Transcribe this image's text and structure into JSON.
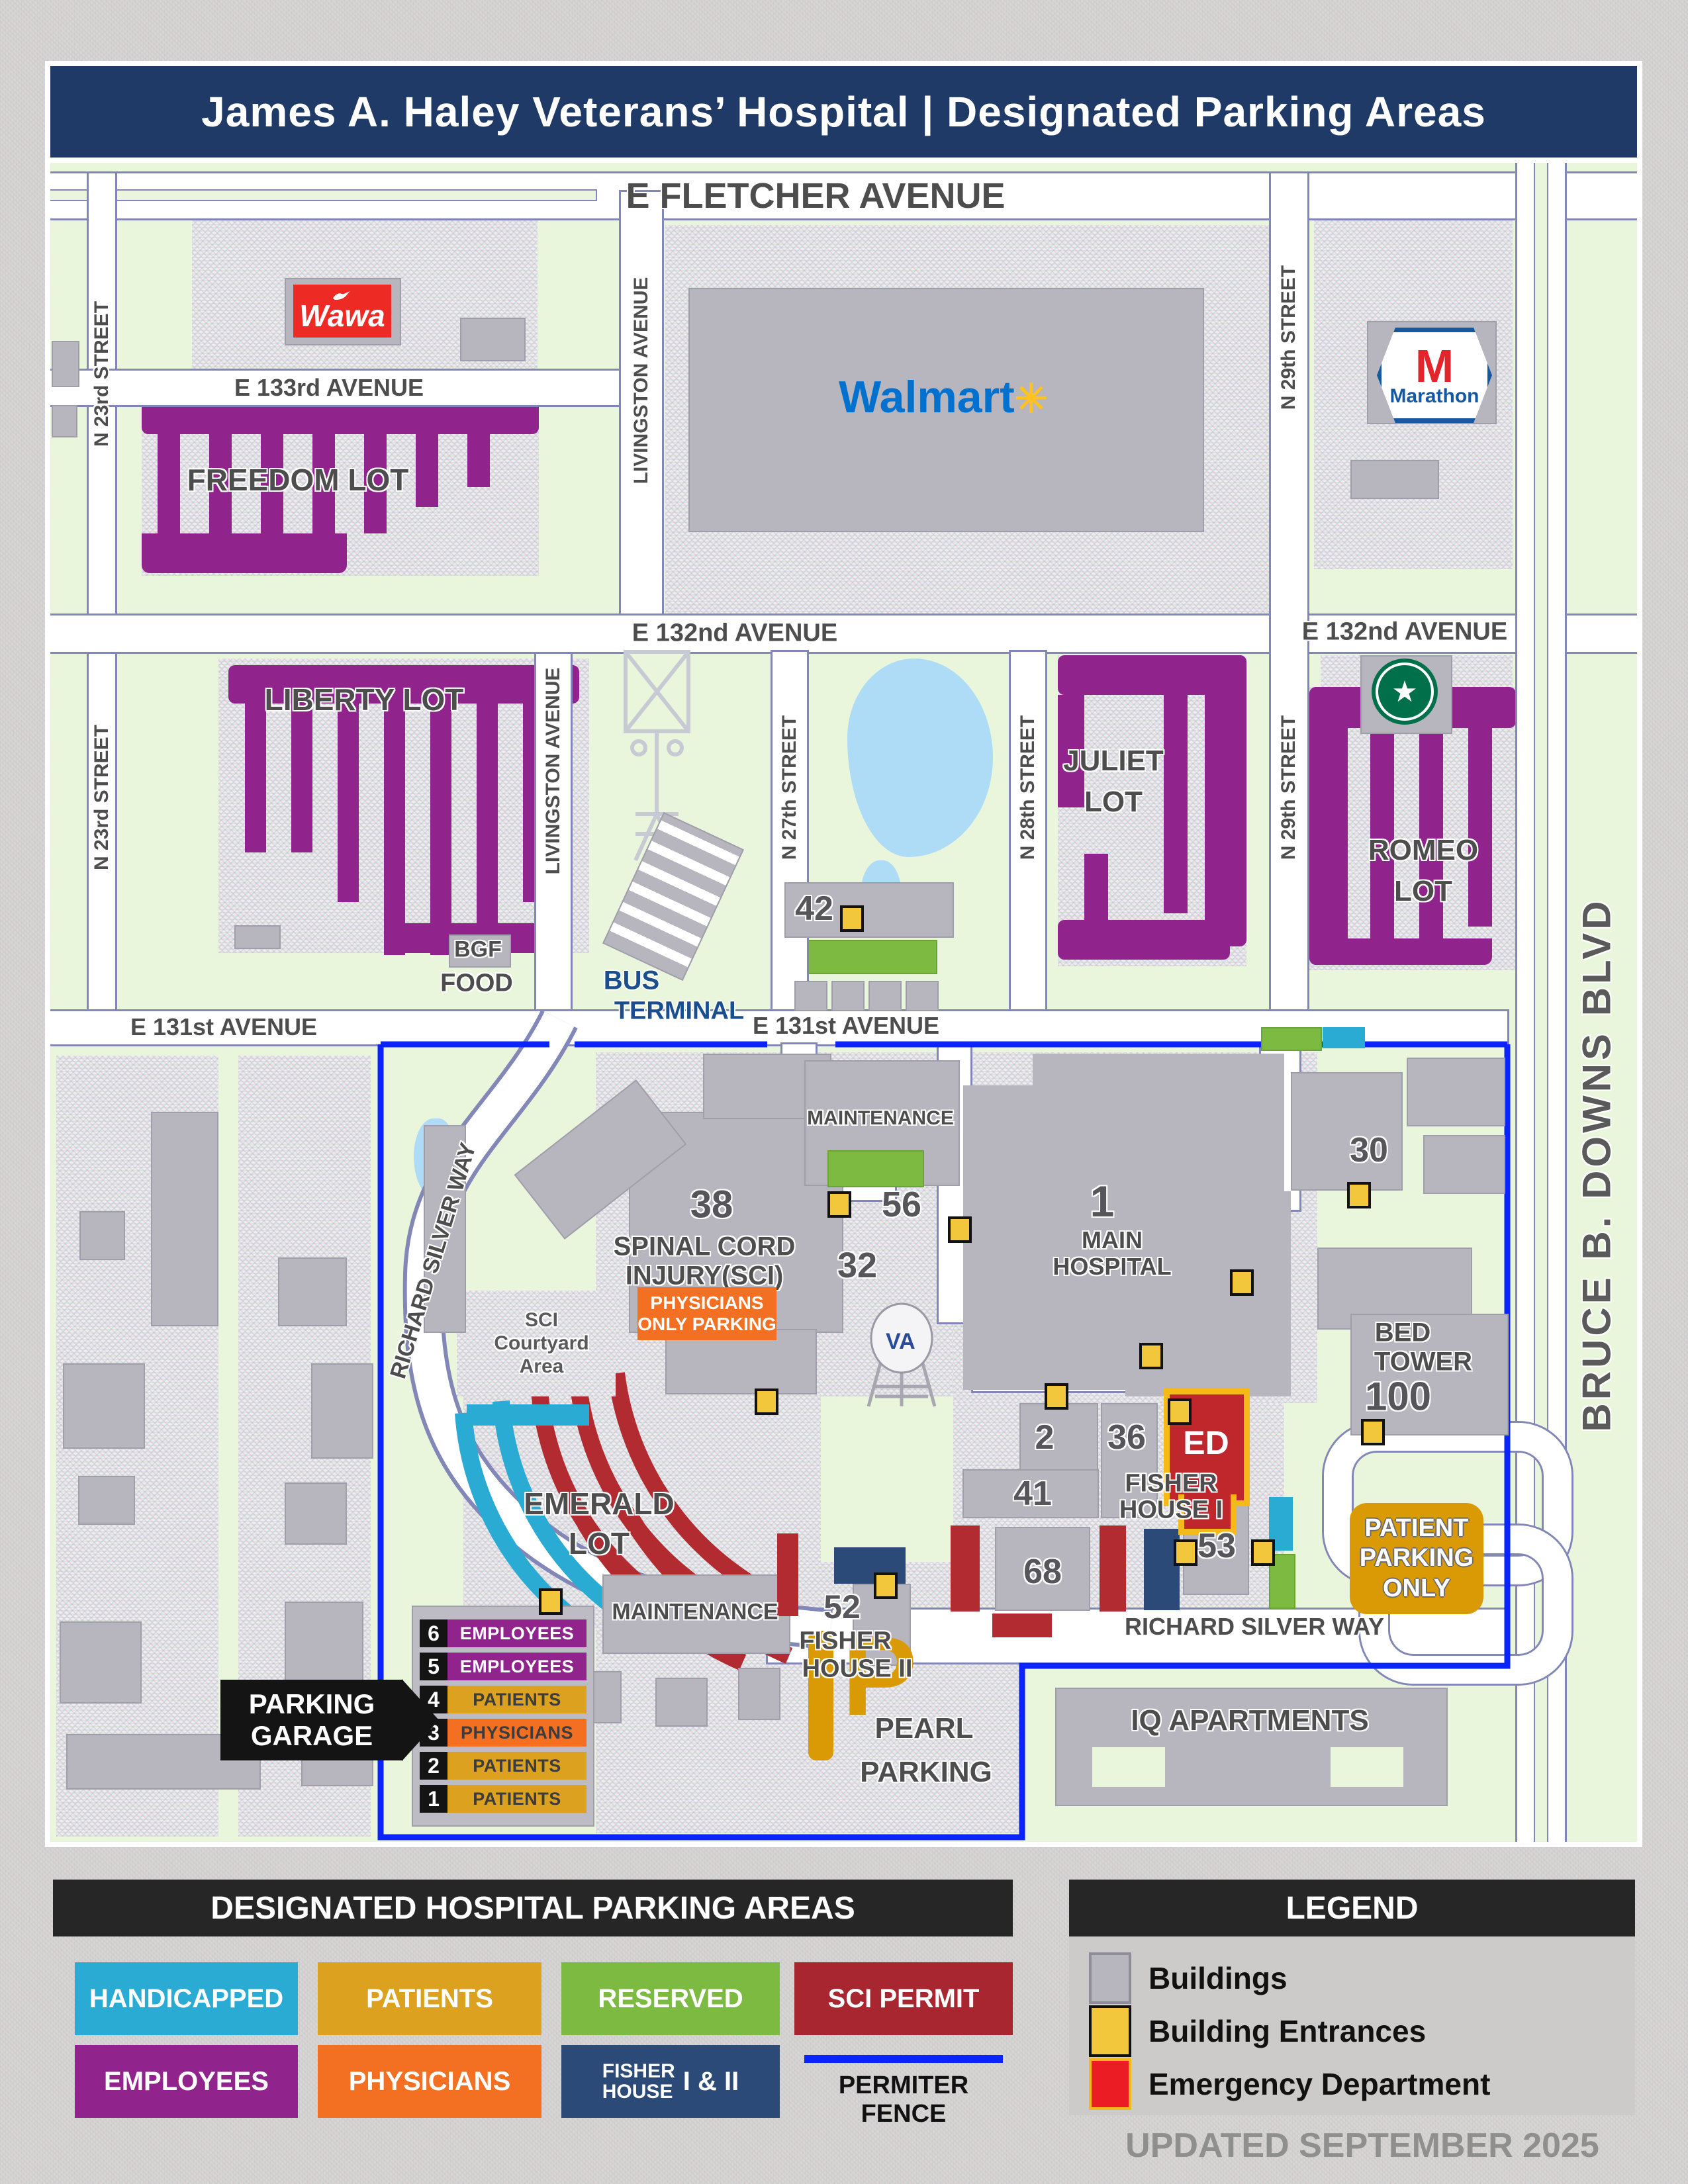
{
  "title": "James A. Haley Veterans’ Hospital  |  Designated Parking Areas",
  "streets": {
    "fletcher": "E FLETCHER AVENUE",
    "e133": "E 133rd AVENUE",
    "e132": "E 132nd AVENUE",
    "e131": "E 131st AVENUE",
    "n23": "N 23rd STREET",
    "livingston": "LIVINGSTON AVENUE",
    "n27": "N 27th STREET",
    "n28": "N 28th STREET",
    "n29": "N 29th STREET",
    "bbd": "BRUCE B. DOWNS BLVD",
    "rsw": "RICHARD SILVER WAY"
  },
  "lots": {
    "freedom": "FREEDOM LOT",
    "liberty": "LIBERTY LOT",
    "juliet_1": "JULIET",
    "juliet_2": "LOT",
    "romeo_1": "ROMEO",
    "romeo_2": "LOT",
    "emerald_1": "EMERALD",
    "emerald_2": "LOT",
    "pearl_1": "PEARL",
    "pearl_2": "PARKING"
  },
  "places": {
    "wawa": "Wawa",
    "walmart": "Walmart",
    "marathon_m": "M",
    "marathon": "Marathon",
    "bgf_1": "BGF",
    "bgf_2": "FOOD",
    "bus_1": "BUS",
    "bus_2": "TERMINAL",
    "iq": "IQ APARTMENTS"
  },
  "campus": {
    "b38_num": "38",
    "b38_1": "SPINAL CORD",
    "b38_2": "INJURY(SCI)",
    "court_1": "SCI",
    "court_2": "Courtyard",
    "court_3": "Area",
    "maintenance": "MAINTENANCE",
    "b56": "56",
    "b32": "32",
    "b1_num": "1",
    "b1_1": "MAIN",
    "b1_2": "HOSPITAL",
    "b30": "30",
    "bed_1": "BED",
    "bed_2": "TOWER",
    "bed_num": "100",
    "b2": "2",
    "b36": "36",
    "ed": "ED",
    "b41": "41",
    "b68": "68",
    "b52": "52",
    "fh2_1": "FISHER",
    "fh2_2": "HOUSE II",
    "b53": "53",
    "fh1_1": "FISHER",
    "fh1_2": "HOUSE I",
    "b42": "42",
    "va": "VA"
  },
  "signs": {
    "ppo_1": "PHYSICIANS",
    "ppo_2": "ONLY PARKING",
    "patient_1": "PATIENT",
    "patient_2": "PARKING",
    "patient_3": "ONLY",
    "garage_1": "PARKING",
    "garage_2": "GARAGE"
  },
  "garage_levels": [
    {
      "num": "6",
      "label": "EMPLOYEES",
      "color": "#90248C"
    },
    {
      "num": "5",
      "label": "EMPLOYEES",
      "color": "#90248C"
    },
    {
      "num": "4",
      "label": "PATIENTS",
      "color": "#DCA21F"
    },
    {
      "num": "3",
      "label": "PHYSICIANS",
      "color": "#F36F21"
    },
    {
      "num": "2",
      "label": "PATIENTS",
      "color": "#DCA21F"
    },
    {
      "num": "1",
      "label": "PATIENTS",
      "color": "#DCA21F"
    }
  ],
  "parking_legend": {
    "title": "DESIGNATED HOSPITAL PARKING AREAS",
    "handicapped": "HANDICAPPED",
    "patients": "PATIENTS",
    "reserved": "RESERVED",
    "sci": "SCI PERMIT",
    "employees": "EMPLOYEES",
    "physicians": "PHYSICIANS",
    "fisher_1": "FISHER",
    "fisher_2": "HOUSE",
    "fisher_suffix": "I & II",
    "fence": "PERMITER FENCE"
  },
  "map_legend": {
    "title": "LEGEND",
    "buildings": "Buildings",
    "entrances": "Building Entrances",
    "ed": "Emergency Department",
    "updated": "UPDATED SEPTEMBER 2025"
  },
  "icons": {
    "wawa_goose": "wawa-goose-icon",
    "walmart_spark": "walmart-spark-icon",
    "marathon_logo": "marathon-logo",
    "starbucks_logo": "starbucks-logo",
    "va_water_tower": "va-water-tower-icon",
    "substation": "substation-icon",
    "garage_arrow": "parking-garage-arrow-icon",
    "entrance_marker": "building-entrance-marker"
  },
  "colors": {
    "title_bar": "#1F3A67",
    "map_green": "#E9F6DB",
    "employees_purple": "#90248C",
    "patients_gold": "#DCA21F",
    "physicians_orange": "#F36F21",
    "handicapped_cyan": "#29ABD4",
    "reserved_green": "#7CBA42",
    "sci_permit_red": "#A82630",
    "fisher_navy": "#2B4A77",
    "perimeter_fence_blue": "#0B24FB",
    "entrance_yellow": "#F2C73B",
    "ed_red": "#C0272D",
    "ed_border_gold": "#F5B91A",
    "building_gray": "#B7B5BD"
  }
}
